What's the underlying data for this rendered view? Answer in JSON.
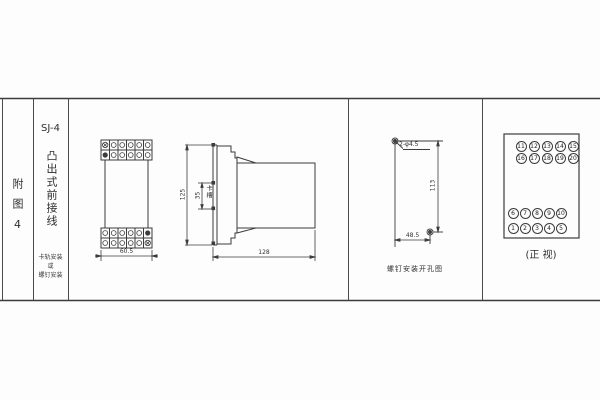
{
  "sheet": {
    "figure_label": "附图4",
    "model": "SJ-4",
    "type_vertical": "凸出式前接线",
    "mount_note": {
      "line1": "卡轨安装",
      "line2": "或",
      "line3": "螺钉安装"
    }
  },
  "outline_drawing": {
    "width_dim": "60.5"
  },
  "side_drawing": {
    "height_dim": "125",
    "slot_dim": "35",
    "slot_label": "卡槽",
    "depth_dim": "128"
  },
  "mounting_drawing": {
    "hole_label": "2-φ4.5",
    "vertical_dim": "113",
    "horizontal_dim": "48.5",
    "caption": "螺钉安装开孔图"
  },
  "front_view": {
    "caption": "(正 视)",
    "rows": [
      [
        "11",
        "12",
        "13",
        "14",
        "15"
      ],
      [
        "16",
        "17",
        "18",
        "19",
        "20"
      ],
      [
        "6",
        "7",
        "8",
        "9",
        "10"
      ],
      [
        "1",
        "2",
        "3",
        "4",
        "5"
      ]
    ]
  }
}
